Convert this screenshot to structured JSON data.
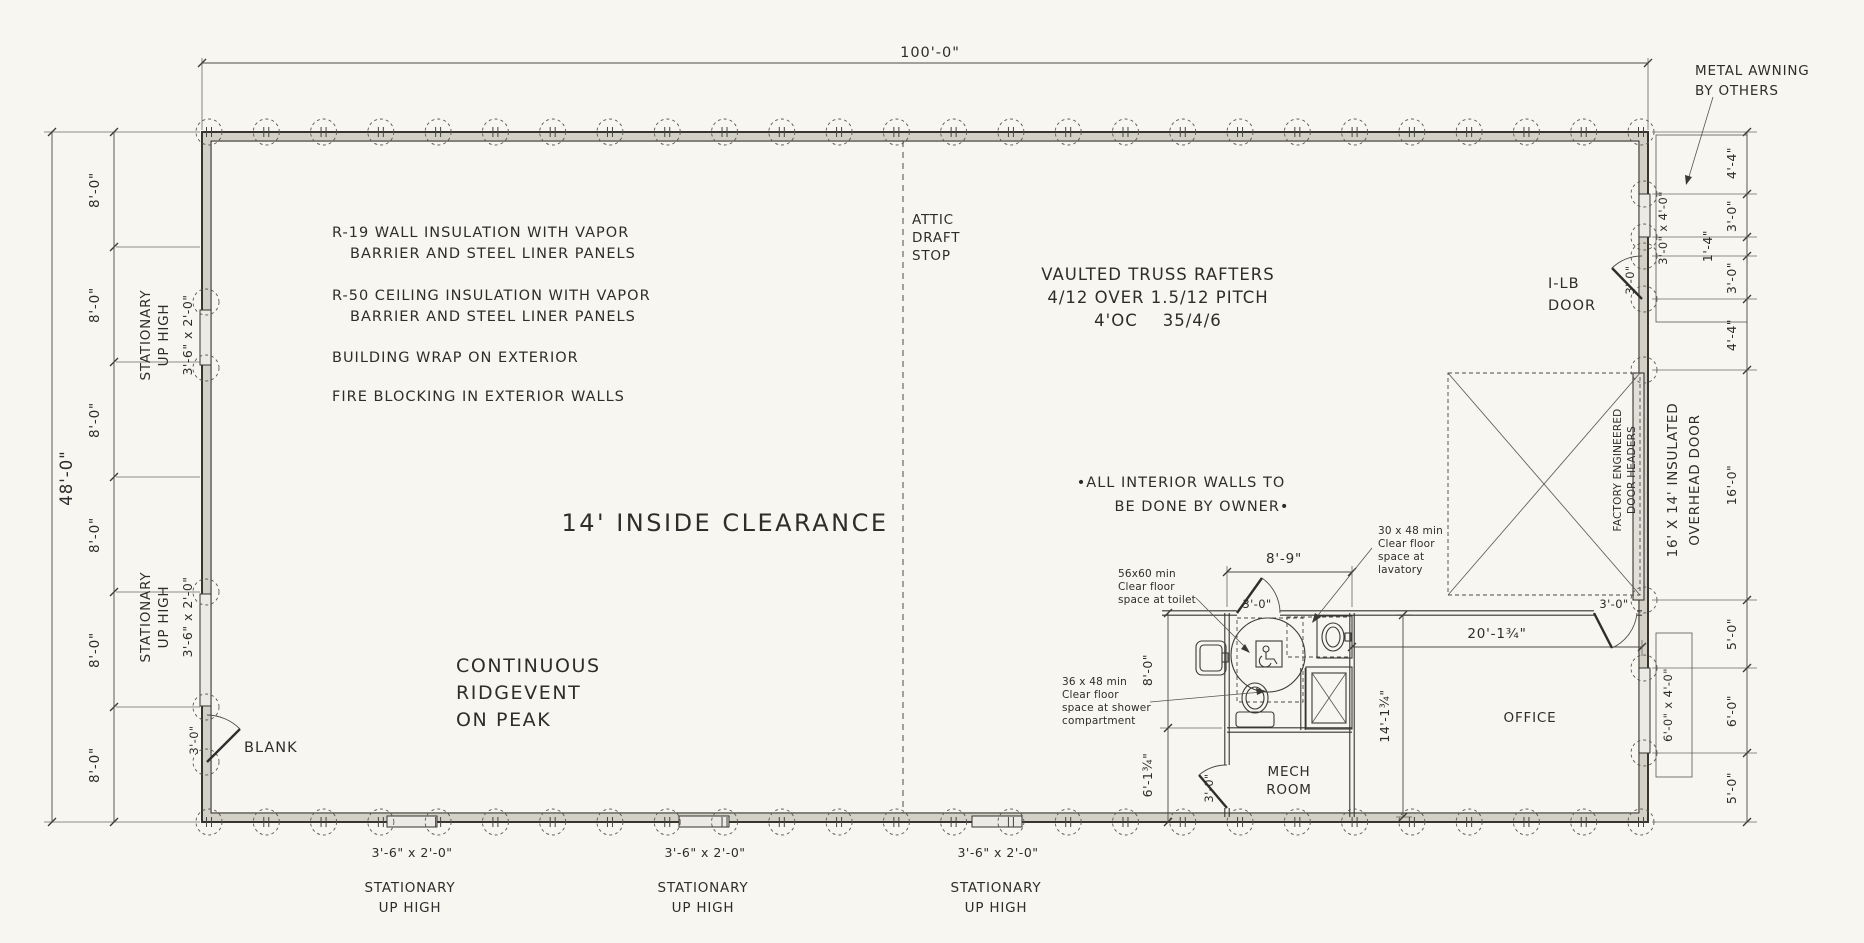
{
  "dims": {
    "total_width": "100'-0\"",
    "total_depth": "48'-0\"",
    "bay": "8'-0\"",
    "r_4_4": "4'-4\"",
    "r_3_0": "3'-0\"",
    "r_1_4": "1'-4\"",
    "r_16_0": "16'-0\"",
    "r_5_0": "5'-0\"",
    "r_6_0": "6'-0\"",
    "bath_w": "8'-9\"",
    "bath_h": "8'-0\"",
    "mech_h": "6'-1¾\"",
    "office_h": "14'-1¾\"",
    "office_w": "20'-1¾\"",
    "door_w": "3'-0\""
  },
  "windows": {
    "stationary_1": "STATIONARY",
    "stationary_2": "UP HIGH",
    "size_3_6": "3'-6\" x 2'-0\"",
    "size_3_0x4_0": "3'-0\" x 4'-0\"",
    "size_6_0x4_0": "6'-0\" x 4'-0\""
  },
  "notes": {
    "r19_1": "R-19 WALL INSULATION WITH VAPOR",
    "r19_2": "BARRIER AND STEEL LINER PANELS",
    "r50_1": "R-50 CEILING INSULATION WITH VAPOR",
    "r50_2": "BARRIER AND STEEL LINER PANELS",
    "wrap": "BUILDING WRAP ON EXTERIOR",
    "fire": "FIRE BLOCKING IN EXTERIOR WALLS",
    "clearance": "14' INSIDE CLEARANCE",
    "ridge_1": "CONTINUOUS",
    "ridge_2": "RIDGEVENT",
    "ridge_3": "ON PEAK",
    "attic_1": "ATTIC",
    "attic_2": "DRAFT",
    "attic_3": "STOP",
    "truss_1": "VAULTED TRUSS RAFTERS",
    "truss_2": "4/12 OVER 1.5/12 PITCH",
    "truss_3": "4'OC    35/4/6",
    "interior_1": "•ALL INTERIOR WALLS TO",
    "interior_2": "BE DONE BY OWNER•",
    "blank": "BLANK",
    "awning_1": "METAL AWNING",
    "awning_2": "BY OTHERS",
    "ilb_1": "I-LB",
    "ilb_2": "DOOR",
    "headers_1": "FACTORY ENGINEERED",
    "headers_2": "DOOR HEADERS",
    "ohd_1": "16' X 14' INSULATED",
    "ohd_2": "OVERHEAD DOOR"
  },
  "ada": {
    "toilet_1": "56x60 min",
    "toilet_2": "Clear floor",
    "toilet_3": "space at toilet",
    "lav_1": "30 x 48 min",
    "lav_2": "Clear floor",
    "lav_3": "space at",
    "lav_4": "lavatory",
    "shower_1": "36 x 48 min",
    "shower_2": "Clear floor",
    "shower_3": "space at shower",
    "shower_4": "compartment"
  },
  "rooms": {
    "mech_1": "MECH",
    "mech_2": "ROOM",
    "office": "OFFICE"
  }
}
